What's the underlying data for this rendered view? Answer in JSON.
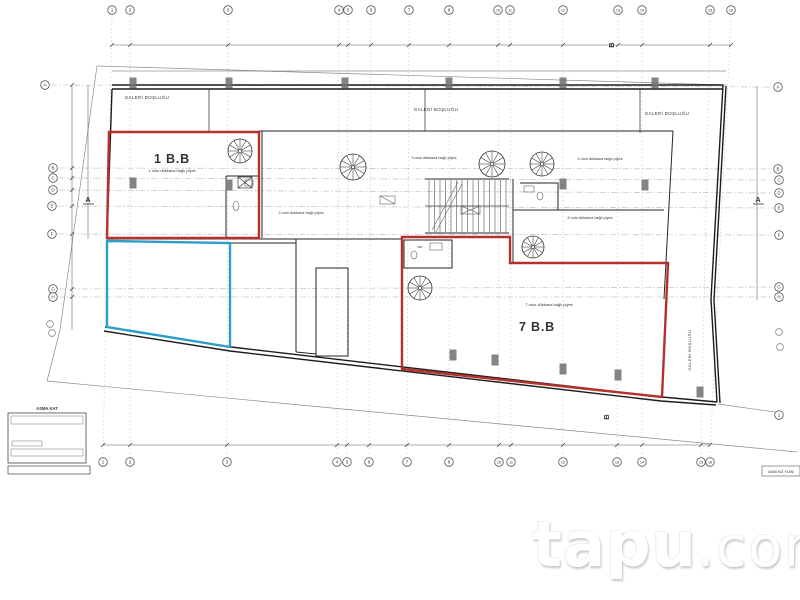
{
  "sheet": {
    "titleblock_heading": "ASMA KAT",
    "corner_label": "ASMA KAT PLANI"
  },
  "drawing": {
    "unit1_label": "1 B.B",
    "unit1_sublabel": "1 nolu dükkana bağlı piyes",
    "unit7_label": "7 B.B",
    "unit7_sublabel": "7 nolu dükkana bağlı piyes",
    "gallery_label": "GALERİ BOŞLUĞU",
    "room_labels": {
      "room2": "2 nolu dükkana bağlı piyes",
      "room3": "3 nolu dükkana bağlı piyes",
      "room4": "4 nolu dükkana bağlı piyes",
      "room5": "5 nolu dükkana bağlı piyes"
    },
    "wc_label": "wc",
    "section_markers": {
      "a": "A",
      "b": "B"
    },
    "grid_labels": {
      "top": [
        "1",
        "2",
        "3",
        "4",
        "5",
        "6",
        "7",
        "8",
        "10",
        "11",
        "12",
        "13",
        "14",
        "15",
        "16"
      ],
      "bottom": [
        "1",
        "2",
        "3",
        "4",
        "5",
        "6",
        "7",
        "8",
        "10",
        "11",
        "12",
        "13",
        "14",
        "15",
        "16"
      ],
      "left": [
        "A",
        "B",
        "C",
        "D",
        "E",
        "F",
        "G",
        "H"
      ],
      "right": [
        "A",
        "B",
        "C",
        "D",
        "E",
        "F",
        "G",
        "H"
      ],
      "extra": "1"
    },
    "colors": {
      "red_outline": "#b5312c",
      "blue_outline": "#2a9fc6"
    }
  },
  "watermark": {
    "main": "tapu",
    "suffix": ".com"
  }
}
